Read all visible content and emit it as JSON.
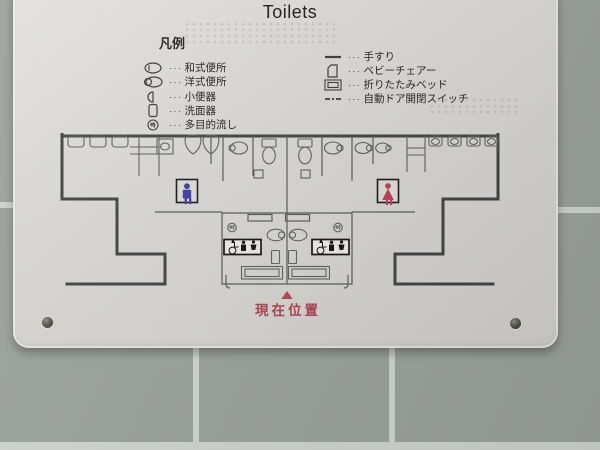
{
  "sign": {
    "title": "Toilets",
    "legend": {
      "heading": "凡例",
      "dots": "···",
      "left": [
        {
          "icon": "squat-toilet-icon",
          "label": "和式便所"
        },
        {
          "icon": "western-toilet-icon",
          "label": "洋式便所"
        },
        {
          "icon": "urinal-icon",
          "label": "小便器"
        },
        {
          "icon": "washbasin-icon",
          "label": "洗面器"
        },
        {
          "icon": "multipurpose-sink-icon",
          "label": "多目的流し"
        }
      ],
      "right": [
        {
          "icon": "handrail-icon",
          "label": "手すり"
        },
        {
          "icon": "baby-chair-icon",
          "label": "ベビーチェアー"
        },
        {
          "icon": "folding-bed-icon",
          "label": "折りたたみベッド"
        },
        {
          "icon": "auto-door-switch-icon",
          "label": "自動ドア開閉スイッチ"
        }
      ]
    },
    "map": {
      "current_location_label": "現在位置",
      "mens_room_symbol": "men-symbol-icon",
      "womens_room_symbol": "women-symbol-icon",
      "accessible_sign_icons": [
        "wheelchair-icon",
        "ostomate-icon",
        "baby-care-icon"
      ],
      "colors": {
        "men_symbol": "#3c3ca6",
        "women_symbol": "#bf3a55",
        "marker_red": "#ad3f4c",
        "wall": "#3e4241"
      }
    }
  }
}
